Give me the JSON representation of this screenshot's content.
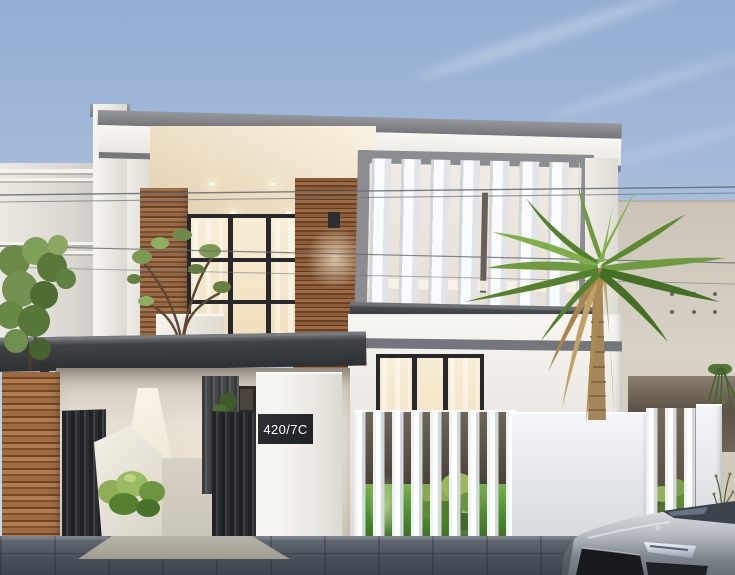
{
  "scene": {
    "address_sign": {
      "text": "420/7C"
    },
    "palette": {
      "sky_top": "#92aed3",
      "sky_horizon": "#cfdbeb",
      "wall_white": "#f6f4f0",
      "wood_accent": "#96663f",
      "roof_gray": "#8a8c8e",
      "slab_dark": "#3c3f42",
      "window_glass_warm": "#f5e8cc",
      "window_frame_black": "#28282c",
      "fence_white": "#eef1f3",
      "grass_green": "#55852f",
      "palm_green": "#6f9a3f",
      "dried_frond_tan": "#c3a267",
      "street_gray": "#4a505a",
      "car_silver": "#b9bec4",
      "sign_background": "#242629",
      "sign_text": "#ffffff"
    }
  }
}
